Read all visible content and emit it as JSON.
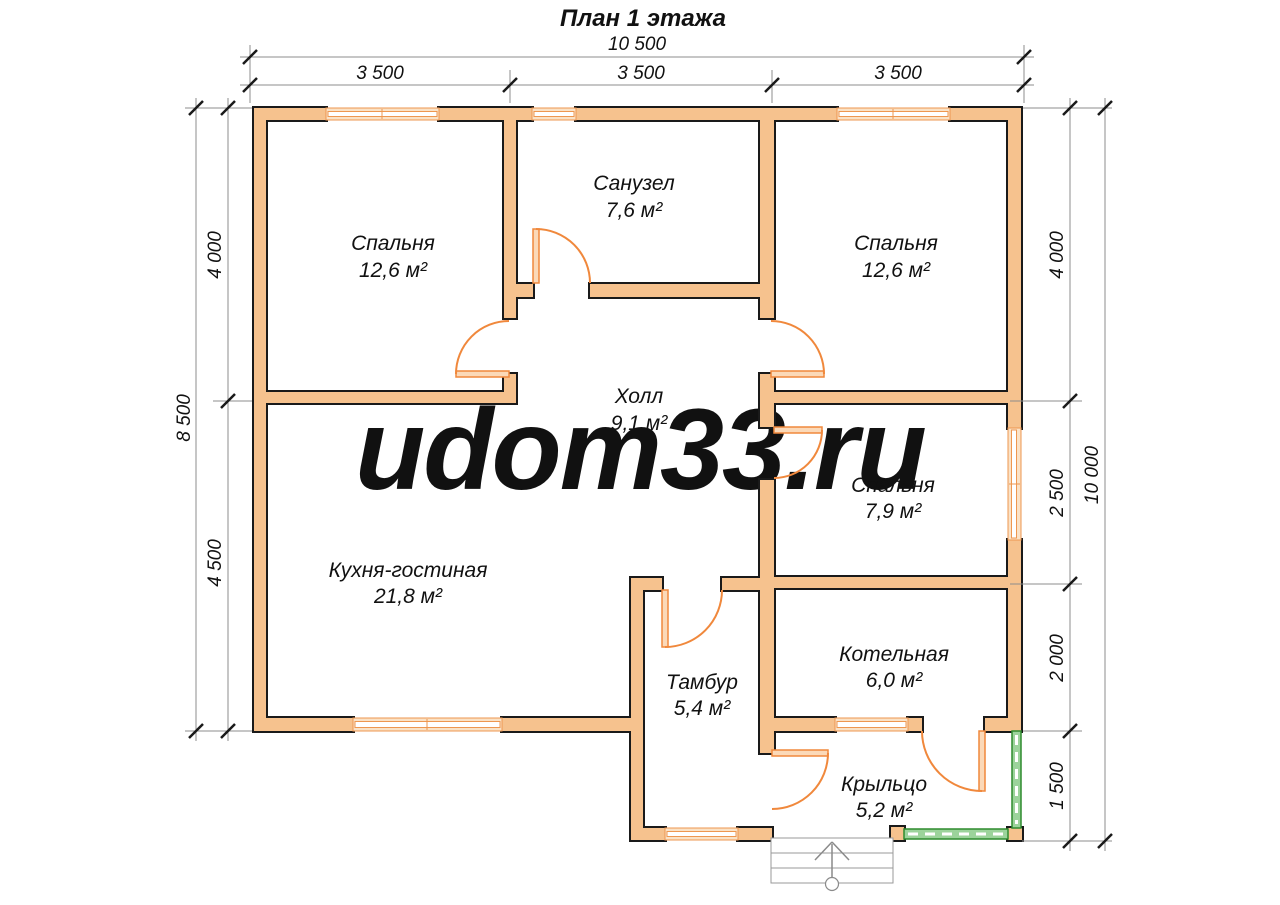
{
  "title": "План 1 этажа",
  "watermark": "udom33.ru",
  "rooms": [
    {
      "name": "Спальня",
      "area": "12,6 м²"
    },
    {
      "name": "Санузел",
      "area": "7,6 м²"
    },
    {
      "name": "Спальня",
      "area": "12,6 м²"
    },
    {
      "name": "Холл",
      "area": "9,1 м²"
    },
    {
      "name": "Спальня",
      "area": "7,9 м²"
    },
    {
      "name": "Кухня-гостиная",
      "area": "21,8 м²"
    },
    {
      "name": "Тамбур",
      "area": "5,4 м²"
    },
    {
      "name": "Котельная",
      "area": "6,0 м²"
    },
    {
      "name": "Крыльцо",
      "area": "5,2 м²"
    }
  ],
  "dimensions": {
    "top": {
      "overall": "10 500",
      "segments": [
        "3 500",
        "3 500",
        "3 500"
      ]
    },
    "left": {
      "overall": "8 500",
      "segments": [
        "4 000",
        "4 500"
      ]
    },
    "right": {
      "overall": "10 000",
      "segments": [
        "4 000",
        "2 500",
        "2 000",
        "1 500"
      ]
    }
  },
  "colors": {
    "wall_fill": "#F6C28E",
    "wall_outline": "#1A1A1A",
    "door": "#F0883C",
    "window_frame": "#EE9750",
    "railing_stroke": "#2E8B2E",
    "railing_fill": "#9CD39B",
    "watermark": "#F5F0C3",
    "dimension_line": "#8C8C8C",
    "steps_gray": "#999999",
    "text": "#111111"
  }
}
